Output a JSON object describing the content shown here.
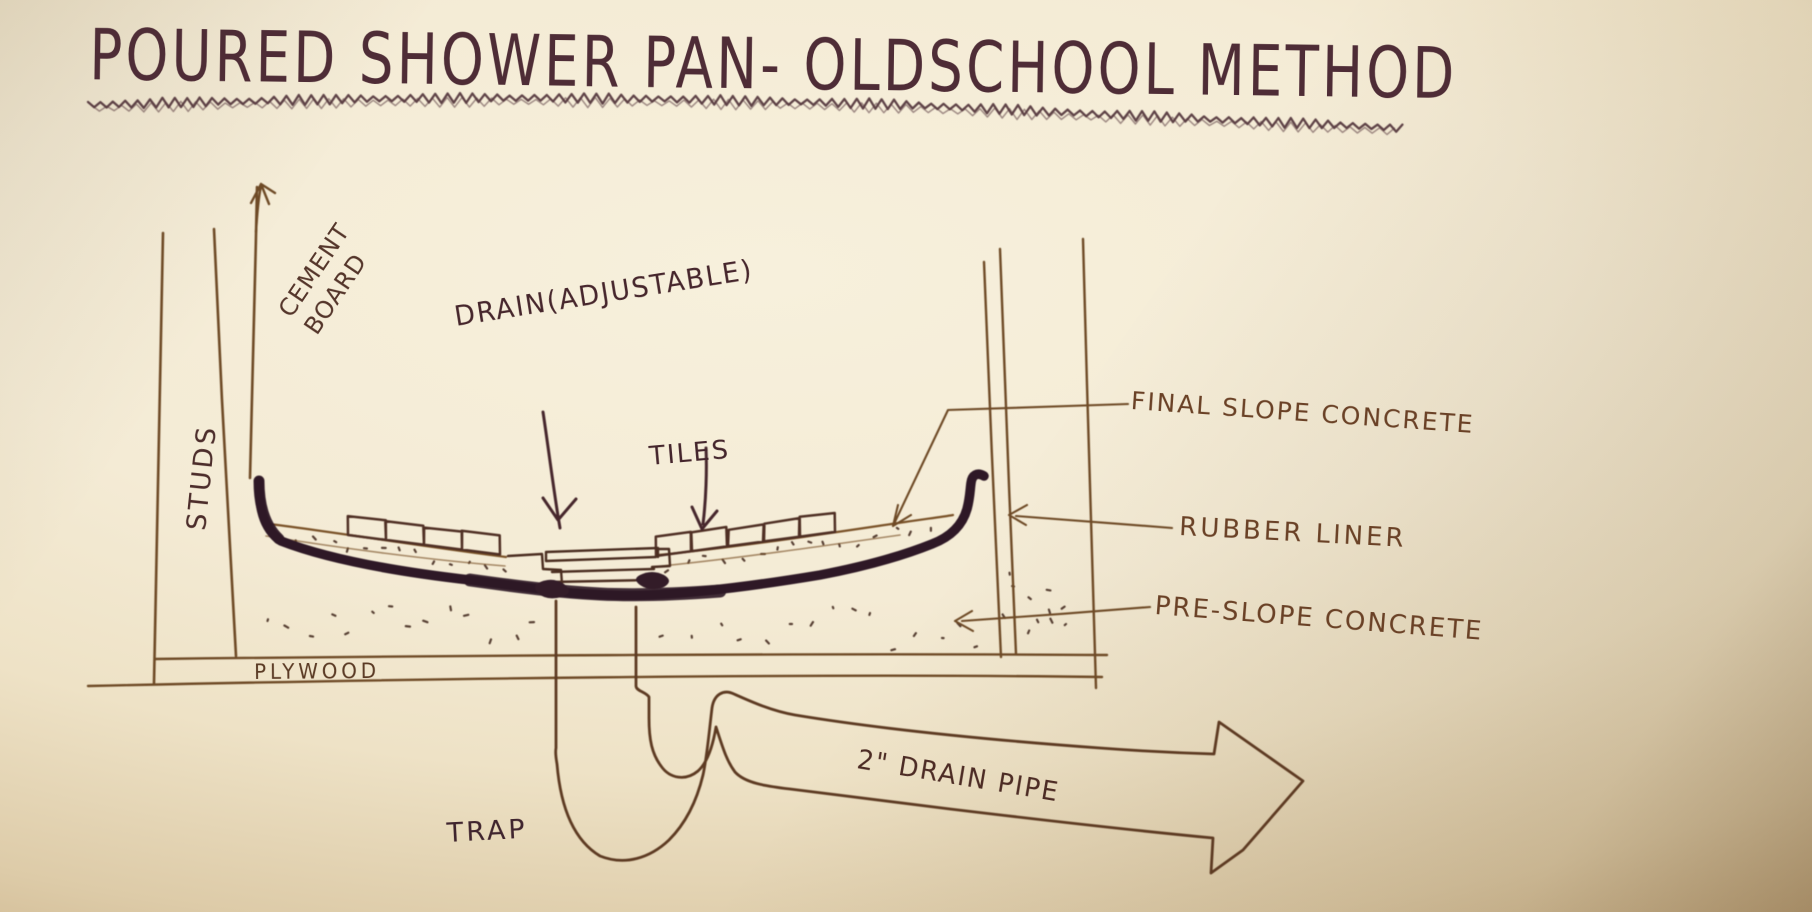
{
  "title": "POURED SHOWER PAN- OLDSCHOOL METHOD",
  "labels": {
    "studs": "STUDS",
    "cement": "CEMENT",
    "board": "BOARD",
    "drain": "DRAIN(ADJUSTABLE)",
    "tiles": "TILES",
    "final_slope": "FINAL SLOPE CONCRETE",
    "rubber_liner": "RUBBER LINER",
    "pre_slope": "PRE-SLOPE CONCRETE",
    "plywood": "PLYWOOD",
    "trap": "TRAP",
    "drain_pipe": "2\" DRAIN PIPE"
  },
  "colors": {
    "paper": "#f4ebd5",
    "paper_edge": "#b69c72",
    "ink_title": "#4e2c36",
    "ink_dark": "#2e1826",
    "ink_line": "#6e4a26",
    "ink_label_brown": "#6a4126",
    "ink_stipple": "#3c2218"
  },
  "diagram_type": "hand-drawn construction cross-section"
}
